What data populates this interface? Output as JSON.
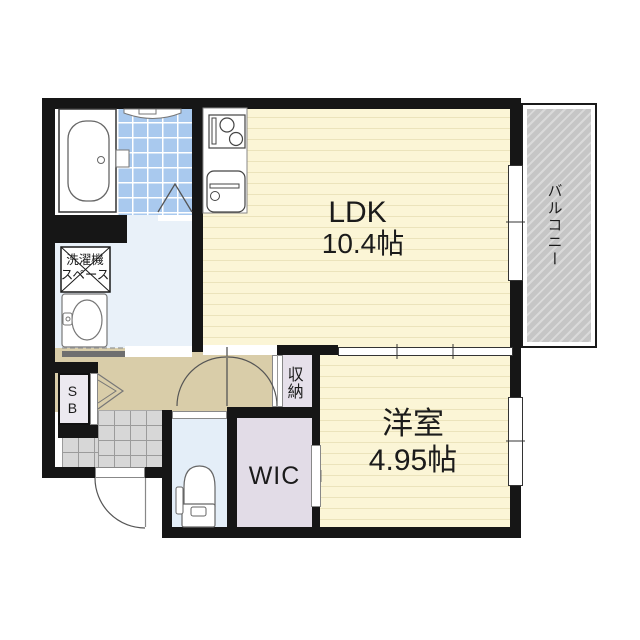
{
  "document": {
    "type": "apartment-floorplan"
  },
  "rooms": {
    "ldk": {
      "label": "LDK",
      "size": "10.4帖",
      "full": "LDK 10.4帖"
    },
    "western_room": {
      "label": "洋室",
      "size": "4.95帖",
      "full": "洋室 4.95帖"
    },
    "wic": {
      "label": "WIC"
    },
    "balcony": {
      "label": "バルコニー"
    },
    "storage": {
      "label": "収納"
    },
    "shoe_box": {
      "label": "SB"
    },
    "laundry_space": {
      "label": "洗濯機スペース",
      "line1": "洗濯機",
      "line2": "スペース"
    }
  },
  "fixtures": [
    "bathtub",
    "bathroom-counter",
    "folding-bath-door",
    "kitchen-stove",
    "kitchen-sink",
    "washbasin",
    "washing-machine-space",
    "toilet",
    "entrance-door",
    "hall-doors",
    "sliding-partition",
    "windows"
  ],
  "colors": {
    "wall": "#161616",
    "tatami_floor": "#fbf5d6",
    "floor_stripe": "#ebe3bb",
    "bathroom_tile": "#a9c9ee",
    "washroom_floor": "#e9f1f9",
    "toilet_floor": "#e4eef8",
    "hallway_floor": "#d9cda9",
    "wic_floor": "#e2dce7",
    "storage_floor": "#e6e0ea",
    "genkan_tile": "#d7d7d7",
    "balcony_hatch": "#c6c6c6"
  }
}
